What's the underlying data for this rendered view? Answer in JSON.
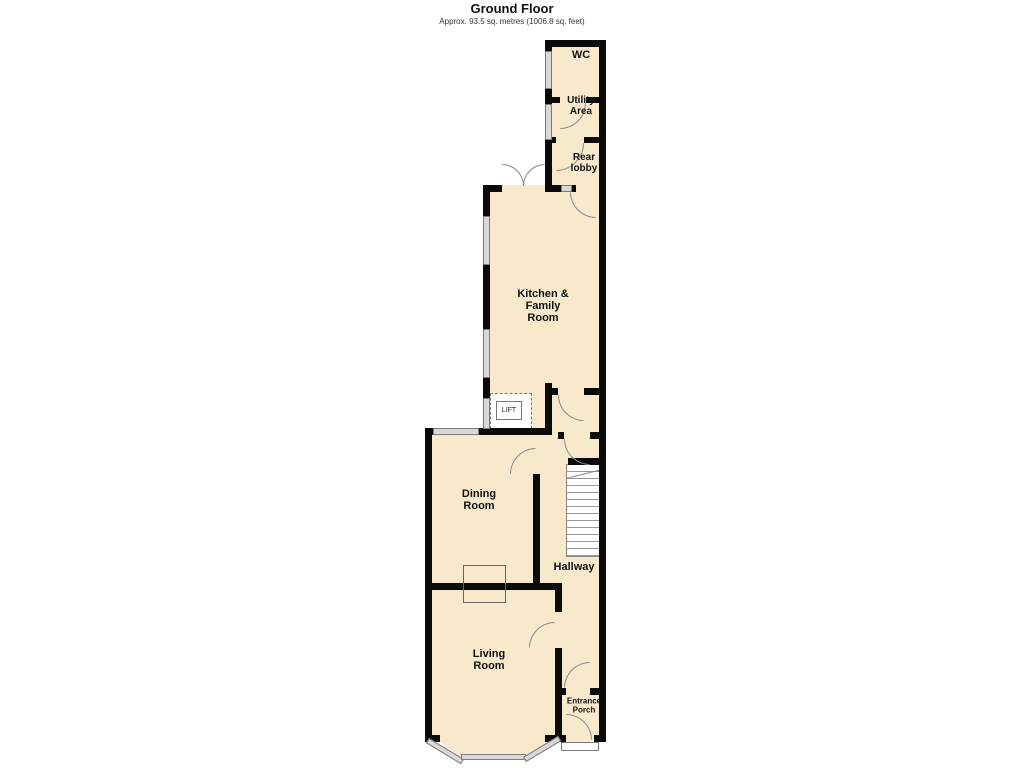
{
  "header": {
    "title": "Ground Floor",
    "subtitle": "Approx. 93.5 sq. metres (1006.8 sq. feet)"
  },
  "rooms": {
    "wc": {
      "label": "WC"
    },
    "utility": {
      "label": "Utility\nArea"
    },
    "rear_lobby": {
      "label": "Rear\nlobby"
    },
    "kitchen": {
      "label": "Kitchen &\nFamily\nRoom"
    },
    "lift": {
      "label": "LIFT"
    },
    "dining": {
      "label": "Dining\nRoom"
    },
    "hallway": {
      "label": "Hallway"
    },
    "living": {
      "label": "Living\nRoom"
    },
    "porch": {
      "label": "Entrance\nPorch"
    }
  },
  "colors": {
    "floor_fill": "#f8e9cd",
    "wall": "#0a0a0a",
    "window_fill": "#d9d9d9",
    "line": "#8a8a8a",
    "background": "#ffffff"
  }
}
